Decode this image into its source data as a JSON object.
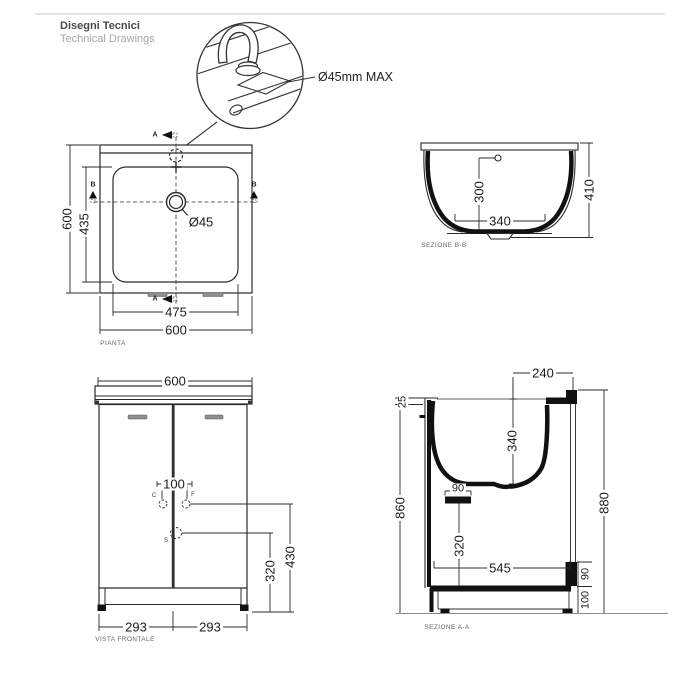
{
  "header": {
    "title_it": "Disegni Tecnici",
    "title_en": "Technical Drawings"
  },
  "detail": {
    "callout": "Ø45mm MAX"
  },
  "plan": {
    "label": "PIANTA",
    "outer_width": "600",
    "outer_depth": "600",
    "basin_width": "475",
    "basin_depth": "435",
    "hole_diameter": "Ø45",
    "marker_a": "A",
    "marker_b": "B"
  },
  "section_bb": {
    "label": "SEZIONE B-B",
    "inner_depth": "300",
    "bottom_width": "340",
    "total_height": "410"
  },
  "front": {
    "label": "VISTA FRONTALE",
    "width": "600",
    "hole_spacing": "100",
    "marker_c": "C",
    "marker_f": "F",
    "marker_s": "S",
    "height_f": "430",
    "height_s": "320",
    "door_width_left": "293",
    "door_width_right": "293"
  },
  "section_aa": {
    "label": "SEZIONE A-A",
    "top_depth": "240",
    "rim": "25",
    "basin_depth": "340",
    "front_height": "860",
    "support_width": "90",
    "lower_height": "320",
    "inner_width": "545",
    "total_height": "880",
    "step_height": "90",
    "plinth_height": "100"
  }
}
